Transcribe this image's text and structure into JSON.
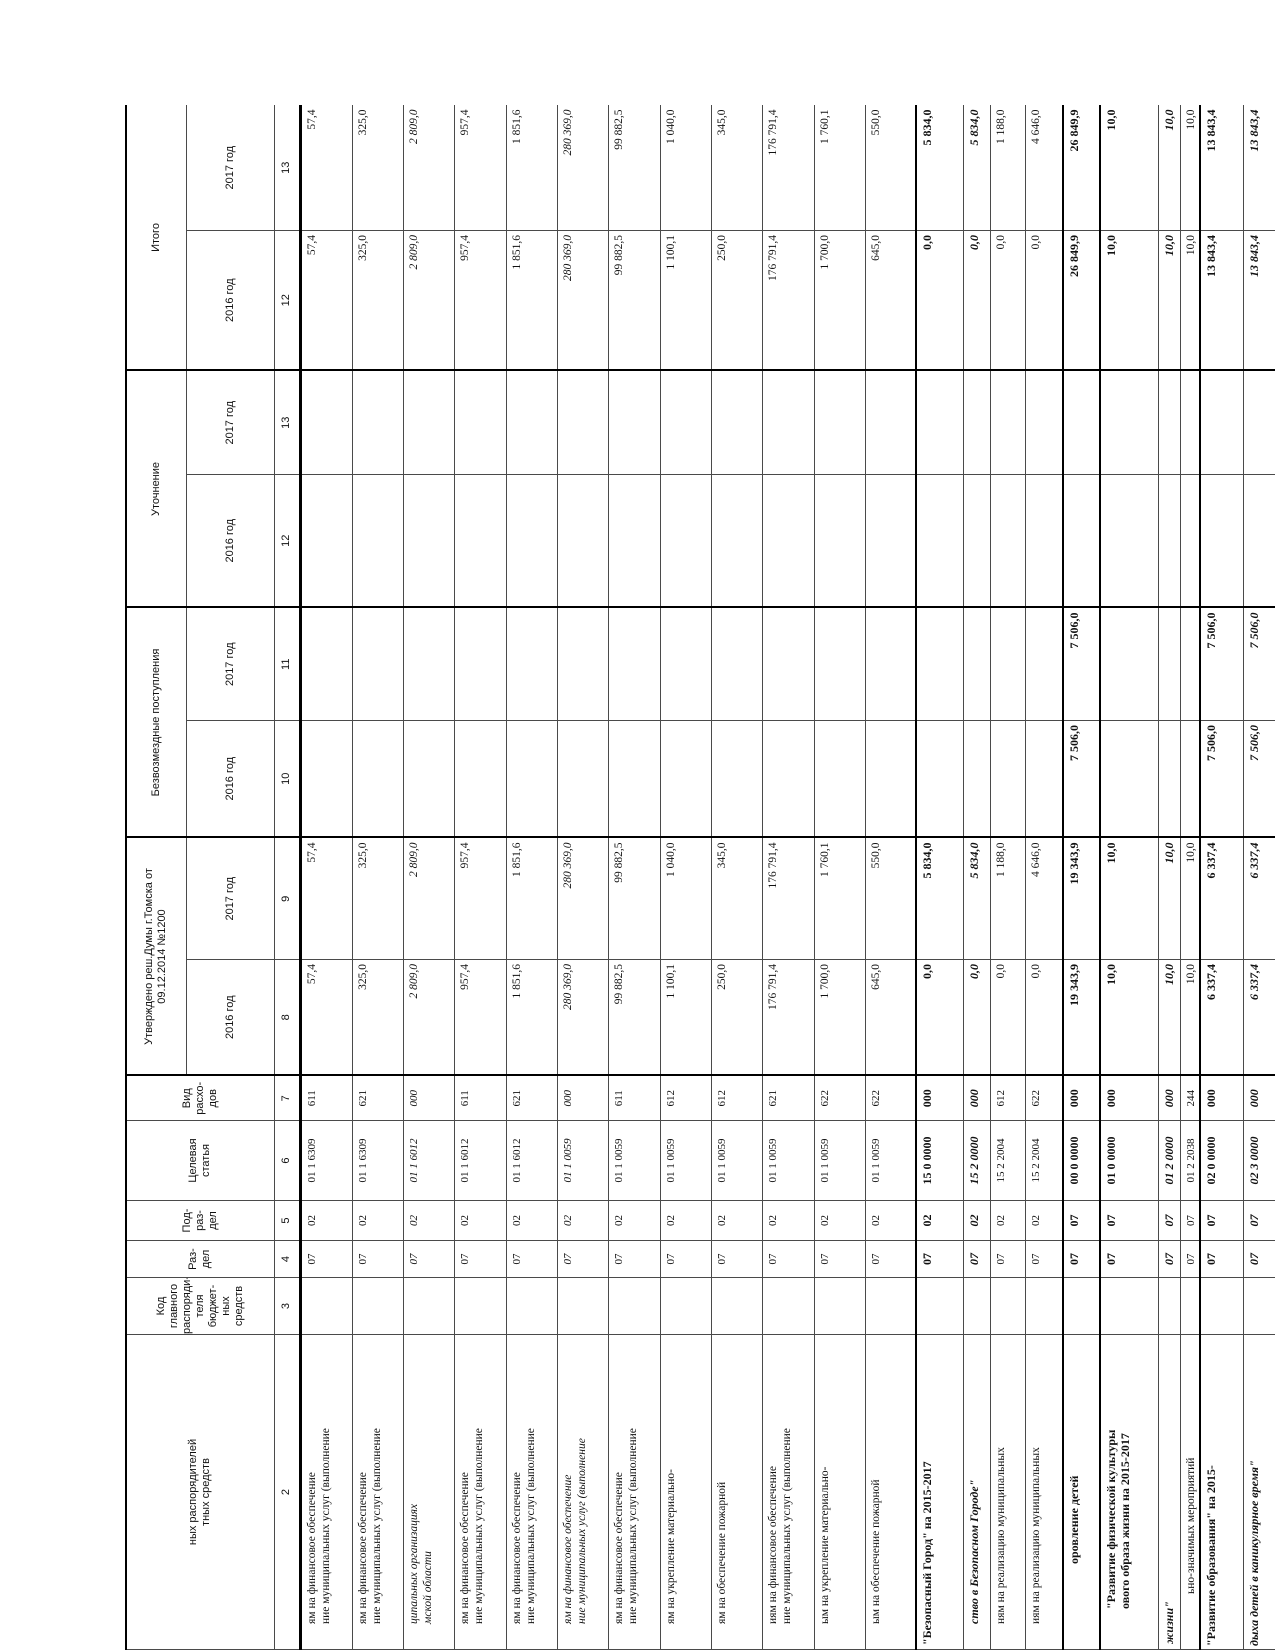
{
  "header": {
    "col_name_fragment": "ных распорядителей\nтных средств",
    "col_kod": "Код\nглавного\nраспоряди-\nтеля\nбюджет-\nных\nсредств",
    "col_razdel": "Раз-\nдел",
    "col_podrazdel": "Под-\nраз-\nдел",
    "col_target": "Целевая\nстатья",
    "col_vid": "Вид\nрасхо-\nдов",
    "group_approved": "Утверждено реш.Думы г.Томска от\n09.12.2014 №1200",
    "group_grants": "Безвозмездные поступления",
    "group_adjust": "Уточнение",
    "group_total": "Итого",
    "year_2016": "2016 год",
    "year_2017": "2017 год",
    "numbers": [
      "2",
      "3",
      "4",
      "5",
      "6",
      "7",
      "8",
      "9",
      "10",
      "11",
      "12",
      "13",
      "12",
      "13"
    ]
  },
  "rows": [
    {
      "style": "normal",
      "h": 52,
      "indent": 25,
      "name": "ям на финансовое обеспечение\nние муниципальных услуг (выполнение",
      "kod": "",
      "rz": "07",
      "pr": "02",
      "cs": "01 1 6309",
      "vr": "611",
      "a16": "57,4",
      "a17": "57,4",
      "g16": "",
      "g17": "",
      "u16": "",
      "u17": "",
      "t16": "57,4",
      "t17": "57,4"
    },
    {
      "style": "normal",
      "h": 51,
      "indent": 25,
      "name": "ям на финансовое обеспечение\nние муниципальных услуг (выполнение",
      "kod": "",
      "rz": "07",
      "pr": "02",
      "cs": "01 1 6309",
      "vr": "621",
      "a16": "325,0",
      "a17": "325,0",
      "g16": "",
      "g17": "",
      "u16": "",
      "u17": "",
      "t16": "325,0",
      "t17": "325,0"
    },
    {
      "style": "italic",
      "h": 51,
      "indent": 25,
      "name": "ципальных организациях\nмской области",
      "kod": "",
      "rz": "07",
      "pr": "02",
      "cs": "01 1 6012",
      "vr": "000",
      "a16": "2 809,0",
      "a17": "2 809,0",
      "g16": "",
      "g17": "",
      "u16": "",
      "u17": "",
      "t16": "2 809,0",
      "t17": "2 809,0"
    },
    {
      "style": "normal",
      "h": 52,
      "indent": 25,
      "name": "ям на финансовое обеспечение\nние муниципальных услуг (выполнение",
      "kod": "",
      "rz": "07",
      "pr": "02",
      "cs": "01 1 6012",
      "vr": "611",
      "a16": "957,4",
      "a17": "957,4",
      "g16": "",
      "g17": "",
      "u16": "",
      "u17": "",
      "t16": "957,4",
      "t17": "957,4"
    },
    {
      "style": "normal",
      "h": 51,
      "indent": 25,
      "name": "ям на финансовое обеспечение\nние муниципальных услуг (выполнение",
      "kod": "",
      "rz": "07",
      "pr": "02",
      "cs": "01 1 6012",
      "vr": "621",
      "a16": "1 851,6",
      "a17": "1 851,6",
      "g16": "",
      "g17": "",
      "u16": "",
      "u17": "",
      "t16": "1 851,6",
      "t17": "1 851,6"
    },
    {
      "style": "italic",
      "h": 51,
      "indent": 25,
      "name": "ям на финансовое обеспечение\nние муниципальных услуг (выполнение",
      "kod": "",
      "rz": "07",
      "pr": "02",
      "cs": "01 1 0059",
      "vr": "000",
      "a16": "280 369,0",
      "a17": "280 369,0",
      "g16": "",
      "g17": "",
      "u16": "",
      "u17": "",
      "t16": "280 369,0",
      "t17": "280 369,0"
    },
    {
      "style": "normal",
      "h": 52,
      "indent": 25,
      "name": "ям на финансовое обеспечение\nние муниципальных услуг (выполнение",
      "kod": "",
      "rz": "07",
      "pr": "02",
      "cs": "01 1 0059",
      "vr": "611",
      "a16": "99 882,5",
      "a17": "99 882,5",
      "g16": "",
      "g17": "",
      "u16": "",
      "u17": "",
      "t16": "99 882,5",
      "t17": "99 882,5"
    },
    {
      "style": "normal",
      "h": 51,
      "indent": 25,
      "name": "ям на укрепление материально-",
      "kod": "",
      "rz": "07",
      "pr": "02",
      "cs": "01 1 0059",
      "vr": "612",
      "a16": "1 100,1",
      "a17": "1 040,0",
      "g16": "",
      "g17": "",
      "u16": "",
      "u17": "",
      "t16": "1 100,1",
      "t17": "1 040,0"
    },
    {
      "style": "normal",
      "h": 51,
      "indent": 25,
      "name": "ям на обеспечение пожарной",
      "kod": "",
      "rz": "07",
      "pr": "02",
      "cs": "01 1 0059",
      "vr": "612",
      "a16": "250,0",
      "a17": "345,0",
      "g16": "",
      "g17": "",
      "u16": "",
      "u17": "",
      "t16": "250,0",
      "t17": "345,0"
    },
    {
      "style": "normal",
      "h": 52,
      "indent": 25,
      "name": "иям на финансовое обеспечение\nние муниципальных услуг (выполнение",
      "kod": "",
      "rz": "07",
      "pr": "02",
      "cs": "01 1 0059",
      "vr": "621",
      "a16": "176 791,4",
      "a17": "176 791,4",
      "g16": "",
      "g17": "",
      "u16": "",
      "u17": "",
      "t16": "176 791,4",
      "t17": "176 791,4"
    },
    {
      "style": "normal",
      "h": 51,
      "indent": 25,
      "name": "ым на укрепление материально-",
      "kod": "",
      "rz": "07",
      "pr": "02",
      "cs": "01 1 0059",
      "vr": "622",
      "a16": "1 700,0",
      "a17": "1 760,1",
      "g16": "",
      "g17": "",
      "u16": "",
      "u17": "",
      "t16": "1 700,0",
      "t17": "1 760,1"
    },
    {
      "style": "normal",
      "h": 51,
      "indent": 25,
      "name": "ым на обеспечение пожарной",
      "kod": "",
      "rz": "07",
      "pr": "02",
      "cs": "01 1 0059",
      "vr": "622",
      "a16": "645,0",
      "a17": "550,0",
      "g16": "",
      "g17": "",
      "u16": "",
      "u17": "",
      "t16": "645,0",
      "t17": "550,0"
    },
    {
      "style": "bold",
      "h": 47,
      "indent": 4,
      "thick": true,
      "name": "\"Безопасный Город\" на 2015-2017",
      "kod": "",
      "rz": "07",
      "pr": "02",
      "cs": "15 0 0000",
      "vr": "000",
      "a16": "0,0",
      "a17": "5 834,0",
      "g16": "",
      "g17": "",
      "u16": "",
      "u17": "",
      "t16": "0,0",
      "t17": "5 834,0"
    },
    {
      "style": "bold-italic",
      "h": 27,
      "indent": 25,
      "name": "ство в Безопасном Городе\"",
      "kod": "",
      "rz": "07",
      "pr": "02",
      "cs": "15 2 0000",
      "vr": "000",
      "a16": "0,0",
      "a17": "5 834,0",
      "g16": "",
      "g17": "",
      "u16": "",
      "u17": "",
      "t16": "0,0",
      "t17": "5 834,0"
    },
    {
      "style": "normal",
      "h": 35,
      "indent": 25,
      "name": "ням на реализацию муниципальных",
      "kod": "",
      "rz": "07",
      "pr": "02",
      "cs": "15 2 2004",
      "vr": "612",
      "a16": "0,0",
      "a17": "1 188,0",
      "g16": "",
      "g17": "",
      "u16": "",
      "u17": "",
      "t16": "0,0",
      "t17": "1 188,0"
    },
    {
      "style": "normal",
      "h": 38,
      "indent": 25,
      "name": "иям на реализацию муниципальных",
      "kod": "",
      "rz": "07",
      "pr": "02",
      "cs": "15 2 2004",
      "vr": "622",
      "a16": "0,0",
      "a17": "4 646,0",
      "g16": "",
      "g17": "",
      "u16": "",
      "u17": "",
      "t16": "0,0",
      "t17": "4 646,0"
    },
    {
      "style": "bold",
      "h": 37,
      "indent": 85,
      "thick": true,
      "name": "оровление детей",
      "kod": "",
      "rz": "07",
      "pr": "07",
      "cs": "00 0 0000",
      "vr": "000",
      "a16": "19 343,9",
      "a17": "19 343,9",
      "g16": "7 506,0",
      "g17": "7 506,0",
      "u16": "",
      "u17": "",
      "t16": "26 849,9",
      "t17": "26 849,9"
    },
    {
      "style": "bold",
      "h": 58,
      "indent": 40,
      "thick": true,
      "name": "\"Развитие физической культуры\nового образа жизни на 2015-2017",
      "kod": "",
      "rz": "07",
      "pr": "07",
      "cs": "01 0 0000",
      "vr": "000",
      "a16": "10,0",
      "a17": "10,0",
      "g16": "",
      "g17": "",
      "u16": "",
      "u17": "",
      "t16": "10,0",
      "t17": "10,0"
    },
    {
      "style": "bold-italic",
      "h": 22,
      "indent": 5,
      "name": "жизни\"",
      "kod": "",
      "rz": "07",
      "pr": "07",
      "cs": "01 2 0000",
      "vr": "000",
      "a16": "10,0",
      "a17": "10,0",
      "g16": "",
      "g17": "",
      "u16": "",
      "u17": "",
      "t16": "10,0",
      "t17": "10,0"
    },
    {
      "style": "normal",
      "h": 20,
      "indent": 55,
      "name": "ьно-значимых мероприятий",
      "kod": "",
      "rz": "07",
      "pr": "07",
      "cs": "01 2 2038",
      "vr": "244",
      "a16": "10,0",
      "a17": "10,0",
      "g16": "",
      "g17": "",
      "u16": "",
      "u17": "",
      "t16": "10,0",
      "t17": "10,0"
    },
    {
      "style": "bold",
      "h": 43,
      "indent": 3,
      "thick": true,
      "name": "\"Развитие образования\" на 2015-",
      "kod": "",
      "rz": "07",
      "pr": "07",
      "cs": "02 0 0000",
      "vr": "000",
      "a16": "6 337,4",
      "a17": "6 337,4",
      "g16": "7 506,0",
      "g17": "7 506,0",
      "u16": "",
      "u17": "",
      "t16": "13 843,4",
      "t17": "13 843,4"
    },
    {
      "style": "bold-italic",
      "h": 40,
      "indent": 3,
      "name": "дыха детей в каникулярное время\"",
      "kod": "",
      "rz": "07",
      "pr": "07",
      "cs": "02 3 0000",
      "vr": "000",
      "a16": "6 337,4",
      "a17": "6 337,4",
      "g16": "7 506,0",
      "g17": "7 506,0",
      "u16": "",
      "u17": "",
      "t16": "13 843,4",
      "t17": "13 843,4"
    }
  ]
}
